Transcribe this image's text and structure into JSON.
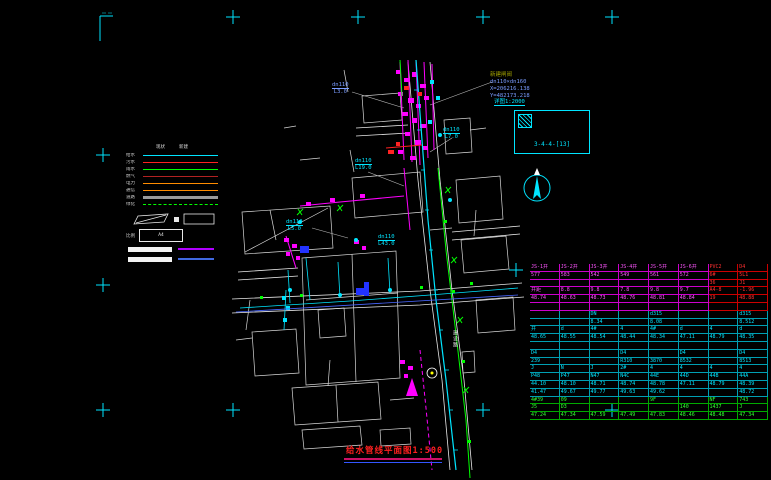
{
  "title": {
    "text": "给水管线平面图",
    "scale": "1:500"
  },
  "annotation_block": {
    "line1": "新建闸阀",
    "line2": "dn110×dn160",
    "line3": "X=206216.138",
    "line4": "Y=482173.218"
  },
  "callout": {
    "caption": "详图1:2000",
    "box_label": "3-4-4-[13]"
  },
  "north_label": "北",
  "map": {
    "road_label": "建设路",
    "labels": [
      {
        "t1": "dn110",
        "t2": "L3.0",
        "x": 332,
        "y": 82,
        "c": "#7a9cff"
      },
      {
        "t1": "dn110",
        "t2": "L19.0",
        "x": 355,
        "y": 158,
        "c": "#00e5ff"
      },
      {
        "t1": "dn110",
        "t2": "L7.0",
        "x": 443,
        "y": 127,
        "c": "#00e5ff"
      },
      {
        "t1": "dn110",
        "t2": "L5.0",
        "x": 286,
        "y": 219,
        "c": "#00e5ff"
      },
      {
        "t1": "dn110",
        "t2": "L43.0",
        "x": 378,
        "y": 234,
        "c": "#00e5ff"
      }
    ]
  },
  "legend": {
    "headers": [
      "现状",
      "新建"
    ],
    "rows": [
      {
        "label": "给水",
        "color": "#00e5ff",
        "style": "solid"
      },
      {
        "label": "污水",
        "color": "#ff2020",
        "style": "solid"
      },
      {
        "label": "雨水",
        "color": "#00ff00",
        "style": "solid"
      },
      {
        "label": "燃气",
        "color": "#b22222",
        "style": "solid"
      },
      {
        "label": "电力",
        "color": "#ff8c00",
        "style": "solid"
      },
      {
        "label": "通信",
        "color": "#ff8c00",
        "style": "solid"
      },
      {
        "label": "道路",
        "color": "#9a9a9a",
        "style": "thick"
      },
      {
        "label": "绿化",
        "color": "#00ff00",
        "style": "dashed"
      }
    ],
    "a4_label": "比例",
    "a4_text": "A4",
    "side_lines": [
      {
        "color": "#b000ff"
      },
      {
        "color": "#4169e1"
      }
    ]
  },
  "table": {
    "rows": [
      {
        "g": "m",
        "red_from": 6,
        "cells": [
          "JS-1井",
          "JS-2井",
          "JS-3井",
          "JS-4井",
          "JS-5井",
          "JS-6井",
          "PVC2",
          "D4"
        ]
      },
      {
        "g": "m",
        "red_from": 6,
        "cells": [
          "577",
          "583",
          "542",
          "549",
          "561",
          "572",
          "6#",
          "5L1"
        ]
      },
      {
        "g": "m",
        "red_from": 6,
        "cells": [
          "",
          "",
          "",
          "",
          "",
          "",
          "36",
          "J1"
        ]
      },
      {
        "g": "m",
        "red_from": 6,
        "cells": [
          "井距",
          "8.8",
          "9.8",
          "7.8",
          "9.8",
          "9.7",
          "A4-8",
          "-1.96"
        ]
      },
      {
        "g": "m",
        "red_from": 6,
        "cells": [
          "48.74",
          "48.63",
          "48.73",
          "48.76",
          "48.81",
          "48.84",
          "19",
          "48.88"
        ]
      },
      {
        "g": "m",
        "red_from": 6,
        "cells": [
          "",
          "",
          "",
          "",
          "",
          "",
          "",
          ""
        ]
      },
      {
        "g": "c",
        "cells": [
          "",
          "",
          "DN",
          "",
          "d315",
          "",
          "",
          "d315"
        ]
      },
      {
        "g": "c",
        "cells": [
          "",
          "",
          "8.34",
          "",
          "8.08",
          "",
          "",
          "8.512"
        ]
      },
      {
        "g": "c",
        "cells": [
          "井",
          "d",
          "4#",
          "4",
          "4#",
          "d",
          "4",
          "d"
        ]
      },
      {
        "g": "c",
        "cells": [
          "48.65",
          "48.55",
          "48.54",
          "48.44",
          "48.34",
          "47.11",
          "48.79",
          "48.35"
        ]
      },
      {
        "g": "c",
        "cells": [
          "",
          "",
          "",
          "",
          "",
          "",
          "",
          ""
        ]
      },
      {
        "g": "c",
        "cells": [
          "D4",
          "",
          "",
          "D4",
          "",
          "D4",
          "",
          "D4"
        ]
      },
      {
        "g": "c",
        "cells": [
          "239",
          "",
          "",
          "R310",
          "3870",
          "8532",
          "",
          "8513"
        ]
      },
      {
        "g": "c",
        "cells": [
          "J",
          "N",
          "J",
          "2#",
          "4",
          "4",
          "4",
          "4"
        ]
      },
      {
        "g": "c",
        "cells": [
          "P48",
          "P47",
          "N47",
          "N4C",
          "44E",
          "44D",
          "44B",
          "44A"
        ]
      },
      {
        "g": "c",
        "cells": [
          "44.10",
          "48.10",
          "48.71",
          "48.74",
          "48.78",
          "47.11",
          "48.79",
          "48.39"
        ]
      },
      {
        "g": "c",
        "cells": [
          "41.47",
          "49.67",
          "49.77",
          "49.63",
          "49.62",
          "",
          "",
          "48.72"
        ]
      },
      {
        "g": "n",
        "cells": [
          "4#39",
          "09",
          "",
          "",
          "9F",
          "",
          "NF",
          "743"
        ]
      },
      {
        "g": "n",
        "cells": [
          "J5",
          "D3",
          "",
          "",
          "",
          "140",
          "1437",
          "J"
        ]
      },
      {
        "g": "n",
        "cells": [
          "47.24",
          "47.34",
          "47.59",
          "47.49",
          "47.83",
          "48.46",
          "48.48",
          "47.34"
        ]
      }
    ]
  },
  "crosses": [
    [
      233,
      17
    ],
    [
      358,
      17
    ],
    [
      483,
      17
    ],
    [
      612,
      17
    ],
    [
      103,
      155
    ],
    [
      103,
      285
    ],
    [
      103,
      410
    ],
    [
      233,
      410
    ],
    [
      483,
      410
    ],
    [
      612,
      410
    ],
    [
      516,
      270
    ]
  ]
}
